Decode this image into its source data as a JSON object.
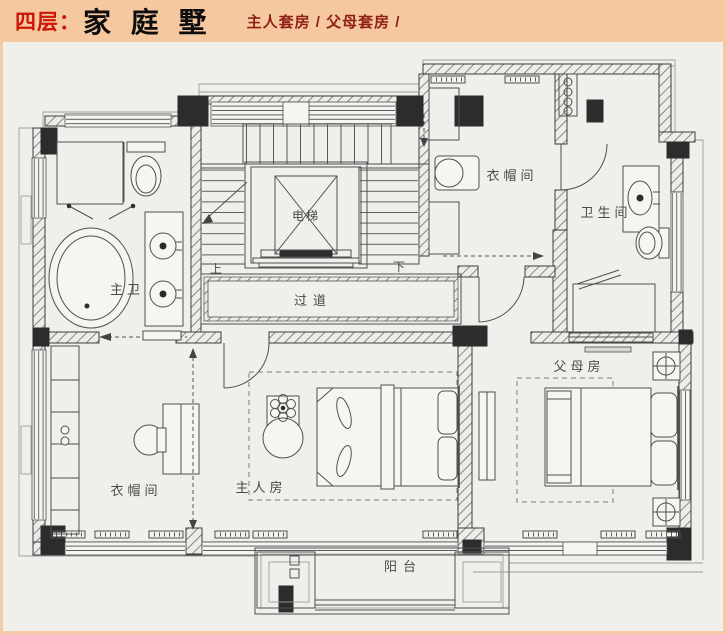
{
  "header": {
    "floor_label": "四层：",
    "title": "家 庭 墅",
    "subtitle": "主人套房 / 父母套房 /"
  },
  "rooms": {
    "elevator": {
      "label": "电梯"
    },
    "corridor": {
      "label": "过道"
    },
    "master_bath": {
      "label": "主卫"
    },
    "cloakroom_upper": {
      "label": "衣帽间"
    },
    "bathroom": {
      "label": "卫生间"
    },
    "cloakroom_lower": {
      "label": "衣帽间"
    },
    "master_bedroom": {
      "label": "主人房"
    },
    "parents_room": {
      "label": "父母房"
    },
    "balcony": {
      "label": "阳台"
    },
    "stairs": {
      "up": "上",
      "down": "下"
    }
  },
  "colors": {
    "frame": "#f5c9a3",
    "header_bg": "#f6c8a0",
    "accent_red": "#cc1504",
    "subtitle_red": "#8e2016",
    "page_bg": "#f1efeb",
    "plan_line": "#4f4f4f",
    "wall_dark": "#2c2c2c"
  }
}
